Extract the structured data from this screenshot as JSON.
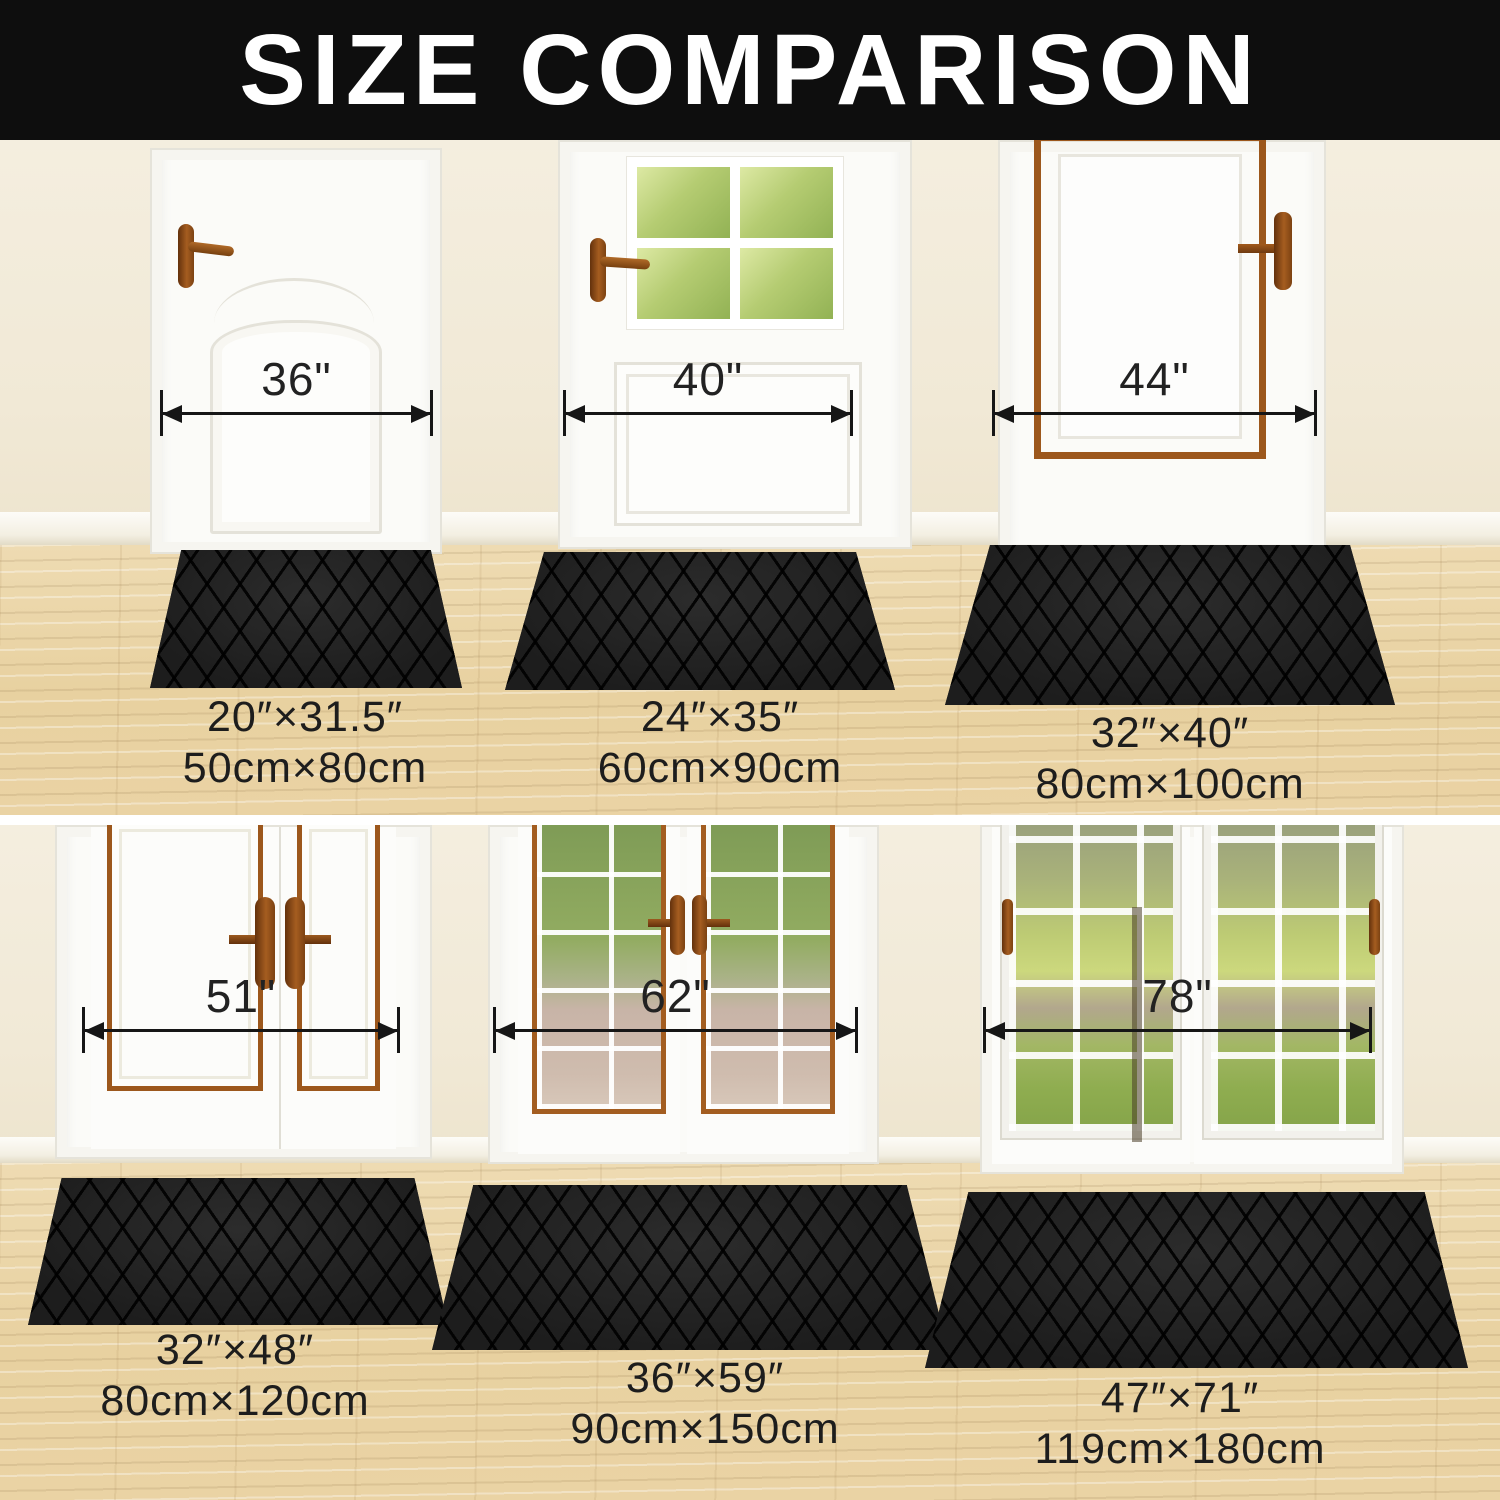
{
  "header": {
    "title": "SIZE COMPARISON"
  },
  "rows": [
    {
      "doors": [
        {
          "door_width": "36\"",
          "mat_inches": "20″×31.5″",
          "mat_cm": "50cm×80cm"
        },
        {
          "door_width": "40\"",
          "mat_inches": "24″×35″",
          "mat_cm": "60cm×90cm"
        },
        {
          "door_width": "44\"",
          "mat_inches": "32″×40″",
          "mat_cm": "80cm×100cm"
        }
      ]
    },
    {
      "doors": [
        {
          "door_width": "51\"",
          "mat_inches": "32″×48″",
          "mat_cm": "80cm×120cm"
        },
        {
          "door_width": "62\"",
          "mat_inches": "36″×59″",
          "mat_cm": "90cm×150cm"
        },
        {
          "door_width": "78\"",
          "mat_inches": "47″×71″",
          "mat_cm": "119cm×180cm"
        }
      ]
    }
  ],
  "colors": {
    "banner_bg": "#0e0e0e",
    "banner_text": "#ffffff",
    "wall_cream": "#f1e9d6",
    "wood_floor": "#e9d3a4",
    "door_white": "#fbfbf8",
    "trim_brown": "#9c571c",
    "mat_black": "#1f1f1f",
    "annotation": "#1c1c1c"
  }
}
